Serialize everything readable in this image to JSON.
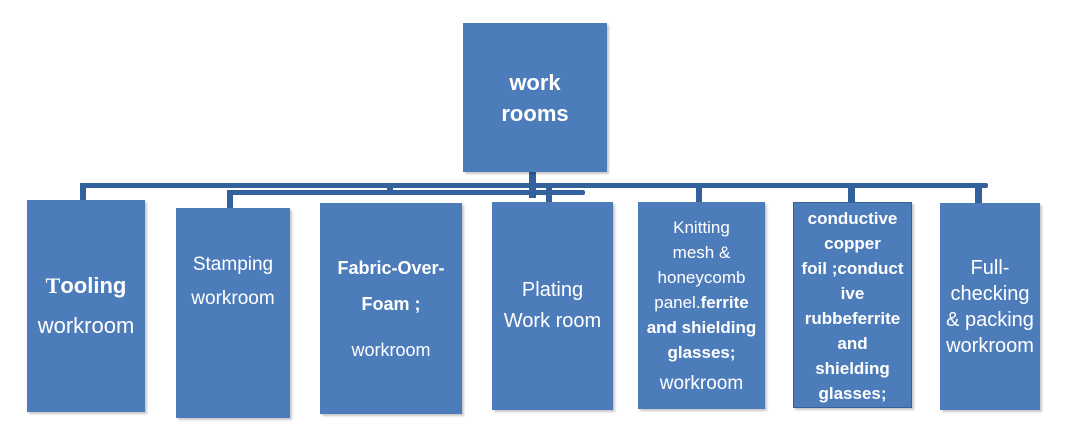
{
  "colors": {
    "box_fill": "#4d7cba",
    "connector": "#33619b",
    "text_on_box": "#ffffff"
  },
  "root_box": {
    "label": "work rooms",
    "lines": [
      {
        "segs": [
          {
            "t": "work"
          }
        ]
      },
      {
        "segs": [
          {
            "t": "rooms"
          }
        ]
      }
    ]
  },
  "child_boxes": [
    {
      "label": "Tooling workroom",
      "lines": [
        {
          "segs": [
            {
              "t": "T",
              "b": true,
              "serif": true
            },
            {
              "t": "ooling",
              "b": true
            }
          ]
        },
        {
          "segs": [
            {
              "t": "workroom"
            }
          ]
        }
      ]
    },
    {
      "label": "Stamping workroom",
      "lines": [
        {
          "segs": [
            {
              "t": "Stamping"
            }
          ]
        },
        {
          "segs": [
            {
              "t": "workroom"
            }
          ]
        }
      ]
    },
    {
      "label": "Fabric-Over-Foam ; workroom",
      "lines": [
        {
          "segs": [
            {
              "t": "Fabric-Over-",
              "b": true
            }
          ]
        },
        {
          "segs": [
            {
              "t": "Foam ;",
              "b": true
            }
          ]
        },
        {
          "gap": 10
        },
        {
          "segs": [
            {
              "t": "workroom"
            }
          ]
        }
      ]
    },
    {
      "label": "Plating Work room",
      "lines": [
        {
          "segs": [
            {
              "t": "Plating"
            }
          ]
        },
        {
          "segs": [
            {
              "t": "Work room"
            }
          ]
        }
      ]
    },
    {
      "label": "Knitting mesh & honeycomb panel.ferrite and shielding glasses; workroom",
      "lines": [
        {
          "segs": [
            {
              "t": "Knitting"
            }
          ]
        },
        {
          "segs": [
            {
              "t": "mesh &"
            }
          ]
        },
        {
          "segs": [
            {
              "t": "honeycomb"
            }
          ]
        },
        {
          "segs": [
            {
              "t": "panel."
            },
            {
              "t": "ferrite",
              "b": true
            }
          ]
        },
        {
          "segs": [
            {
              "t": "and shielding",
              "b": true
            }
          ]
        },
        {
          "segs": [
            {
              "t": "glasses;",
              "b": true
            }
          ]
        },
        {
          "gap": 6
        },
        {
          "segs": [
            {
              "t": "workroom",
              "size": 19
            }
          ]
        }
      ]
    },
    {
      "label": "conductive copper foil ;conductive rubbeferrite and shielding glasses;",
      "lines": [
        {
          "segs": [
            {
              "t": "conductive",
              "b": true
            }
          ]
        },
        {
          "segs": [
            {
              "t": "copper",
              "b": true
            }
          ]
        },
        {
          "segs": [
            {
              "t": "foil ;conduct",
              "b": true
            }
          ]
        },
        {
          "segs": [
            {
              "t": "ive",
              "b": true
            }
          ]
        },
        {
          "segs": [
            {
              "t": "rubbeferrite",
              "b": true
            }
          ]
        },
        {
          "segs": [
            {
              "t": "and",
              "b": true
            }
          ]
        },
        {
          "segs": [
            {
              "t": "shielding",
              "b": true
            }
          ]
        },
        {
          "segs": [
            {
              "t": "glasses;",
              "b": true
            }
          ]
        }
      ]
    },
    {
      "label": "Full-checking & packing workroom",
      "lines": [
        {
          "segs": [
            {
              "t": "Full-"
            }
          ]
        },
        {
          "segs": [
            {
              "t": "checking"
            }
          ]
        },
        {
          "segs": [
            {
              "t": "& packing"
            }
          ]
        },
        {
          "segs": [
            {
              "t": "workroom"
            }
          ]
        }
      ]
    }
  ]
}
